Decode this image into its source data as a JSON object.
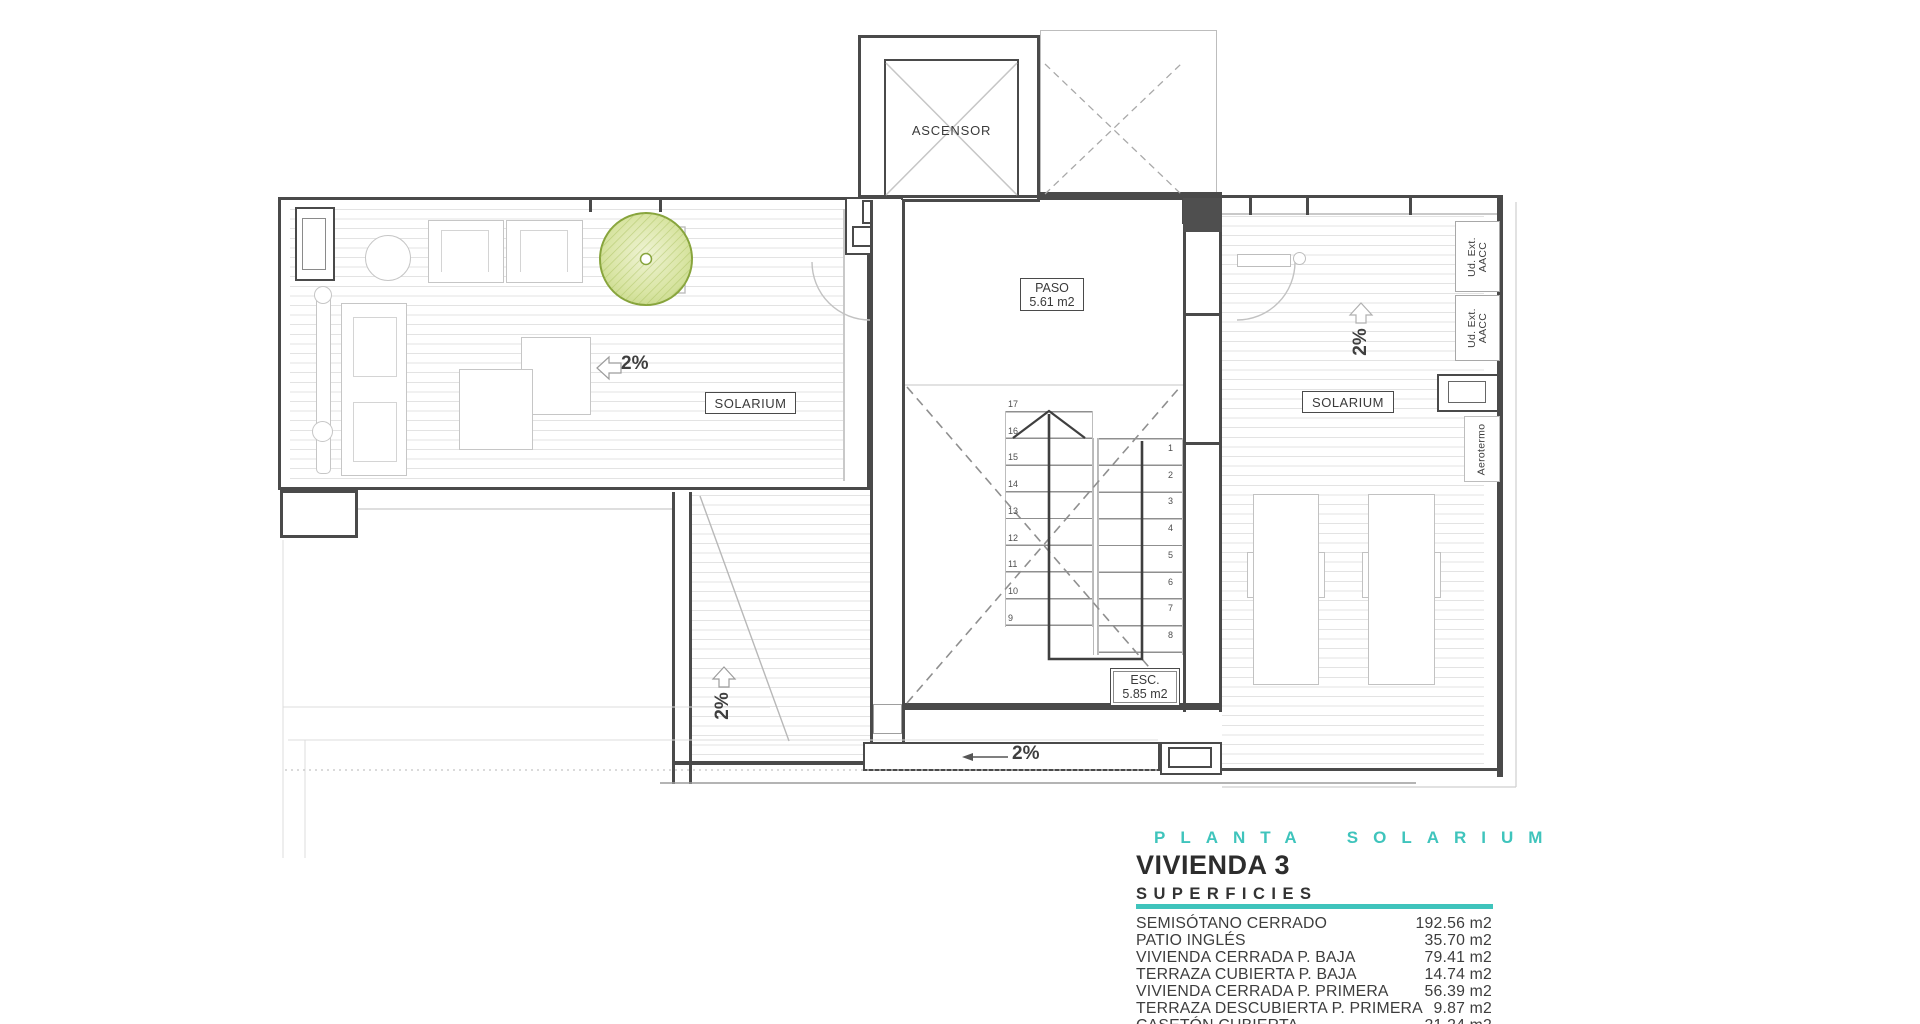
{
  "plan": {
    "elevator": {
      "label": "ASCENSOR"
    },
    "paso": {
      "name": "PASO",
      "area": "5.61 m2"
    },
    "esc": {
      "name": "ESC.",
      "area": "5.85 m2"
    },
    "solarium_left": {
      "label": "SOLARIUM",
      "slope": "2%"
    },
    "solarium_right": {
      "label": "SOLARIUM",
      "slope": "2%"
    },
    "lower_terrace": {
      "slope": "2%"
    },
    "walkway": {
      "slope": "2%"
    },
    "stairs": {
      "left_flight_numbers": [
        "17",
        "16",
        "15",
        "14",
        "13",
        "12",
        "11",
        "10",
        "9"
      ],
      "right_flight_numbers": [
        "1",
        "2",
        "3",
        "4",
        "5",
        "6",
        "7",
        "8"
      ]
    },
    "equipment": {
      "ac_unit_1": "Ud. Ext.\nAACC",
      "ac_unit_2": "Ud. Ext.\nAACC",
      "aerotermo": "Aerotermo"
    }
  },
  "title_block": {
    "plan_title": "PLANTA SOLARIUM",
    "unit_title": "VIVIENDA 3",
    "table_title": "SUPERFICIES",
    "accent_color": "#3fc4bc",
    "rows": [
      {
        "label": "SEMISÓTANO CERRADO",
        "value": "192.56 m2"
      },
      {
        "label": "PATIO INGLÉS",
        "value": "35.70 m2"
      },
      {
        "label": "VIVIENDA CERRADA P. BAJA",
        "value": "79.41 m2"
      },
      {
        "label": "TERRAZA CUBIERTA P. BAJA",
        "value": "14.74 m2"
      },
      {
        "label": "VIVIENDA CERRADA P. PRIMERA",
        "value": "56.39 m2"
      },
      {
        "label": "TERRAZA DESCUBIERTA P. PRIMERA",
        "value": "9.87 m2"
      },
      {
        "label": "CASETÓN CUBIERTA",
        "value": "21.24 m2"
      }
    ]
  }
}
